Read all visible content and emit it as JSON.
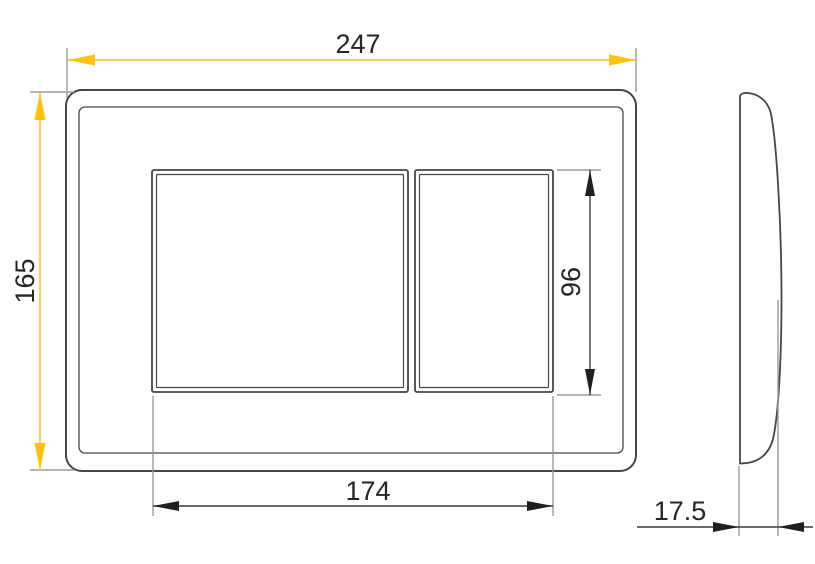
{
  "drawing": {
    "dimensions": {
      "overall_width": "247",
      "overall_height": "165",
      "buttons_width": "174",
      "button_height": "96",
      "depth": "17.5"
    }
  },
  "colors": {
    "background": "#FFFFFF",
    "accent_line": "#F6D06A",
    "accent_arrow": "#FFC20E",
    "dark_line": "#3C3C3C",
    "extension_line": "#9B9B9B",
    "outline": "#474747",
    "text": "#262626"
  }
}
